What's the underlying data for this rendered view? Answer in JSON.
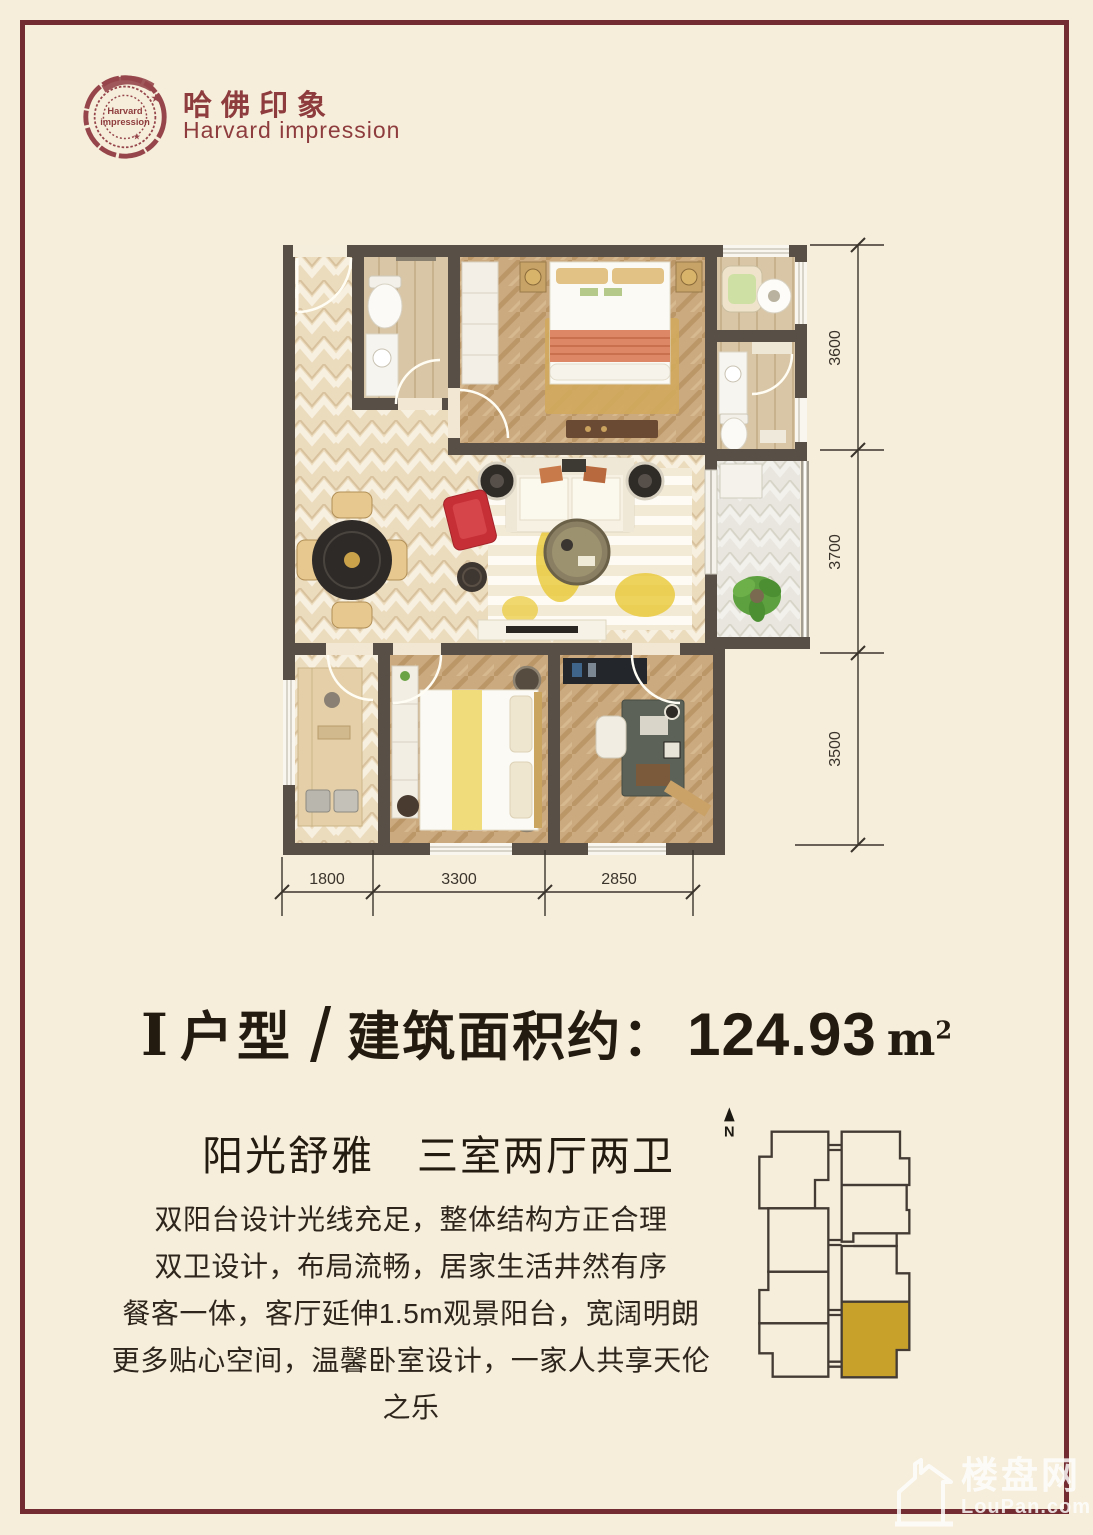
{
  "page": {
    "background_color": "#f6eedb",
    "frame_color": "#732d32"
  },
  "logo": {
    "stamp_line1": "Harvard",
    "stamp_line2": "impression",
    "name_cn": "哈佛印象",
    "name_en": "Harvard impression",
    "color": "#8e3c3d"
  },
  "floor_plan": {
    "dim_right": [
      "3600",
      "3700",
      "3500"
    ],
    "dim_bottom": [
      "1800",
      "3300",
      "2850"
    ],
    "wall_color": "#584f47"
  },
  "title": {
    "roman": "I",
    "type_label": "户型",
    "slash": "/",
    "area_label": "建筑面积约：",
    "area_value": "124.93",
    "area_unit_base": "m",
    "area_unit_exp": "2"
  },
  "subtitle": "阳光舒雅　三室两厅两卫",
  "description": [
    "双阳台设计光线充足，整体结构方正合理",
    "双卫设计，布局流畅，居家生活井然有序",
    "餐客一体，客厅延伸1.5m观景阳台，宽阔明朗",
    "更多贴心空间，温馨卧室设计，一家人共享天伦之乐"
  ],
  "key_plan": {
    "north_label": "N",
    "highlight_color": "#c8a12b"
  },
  "watermark": {
    "cn": "楼盘网",
    "en": "LouPan.com"
  }
}
